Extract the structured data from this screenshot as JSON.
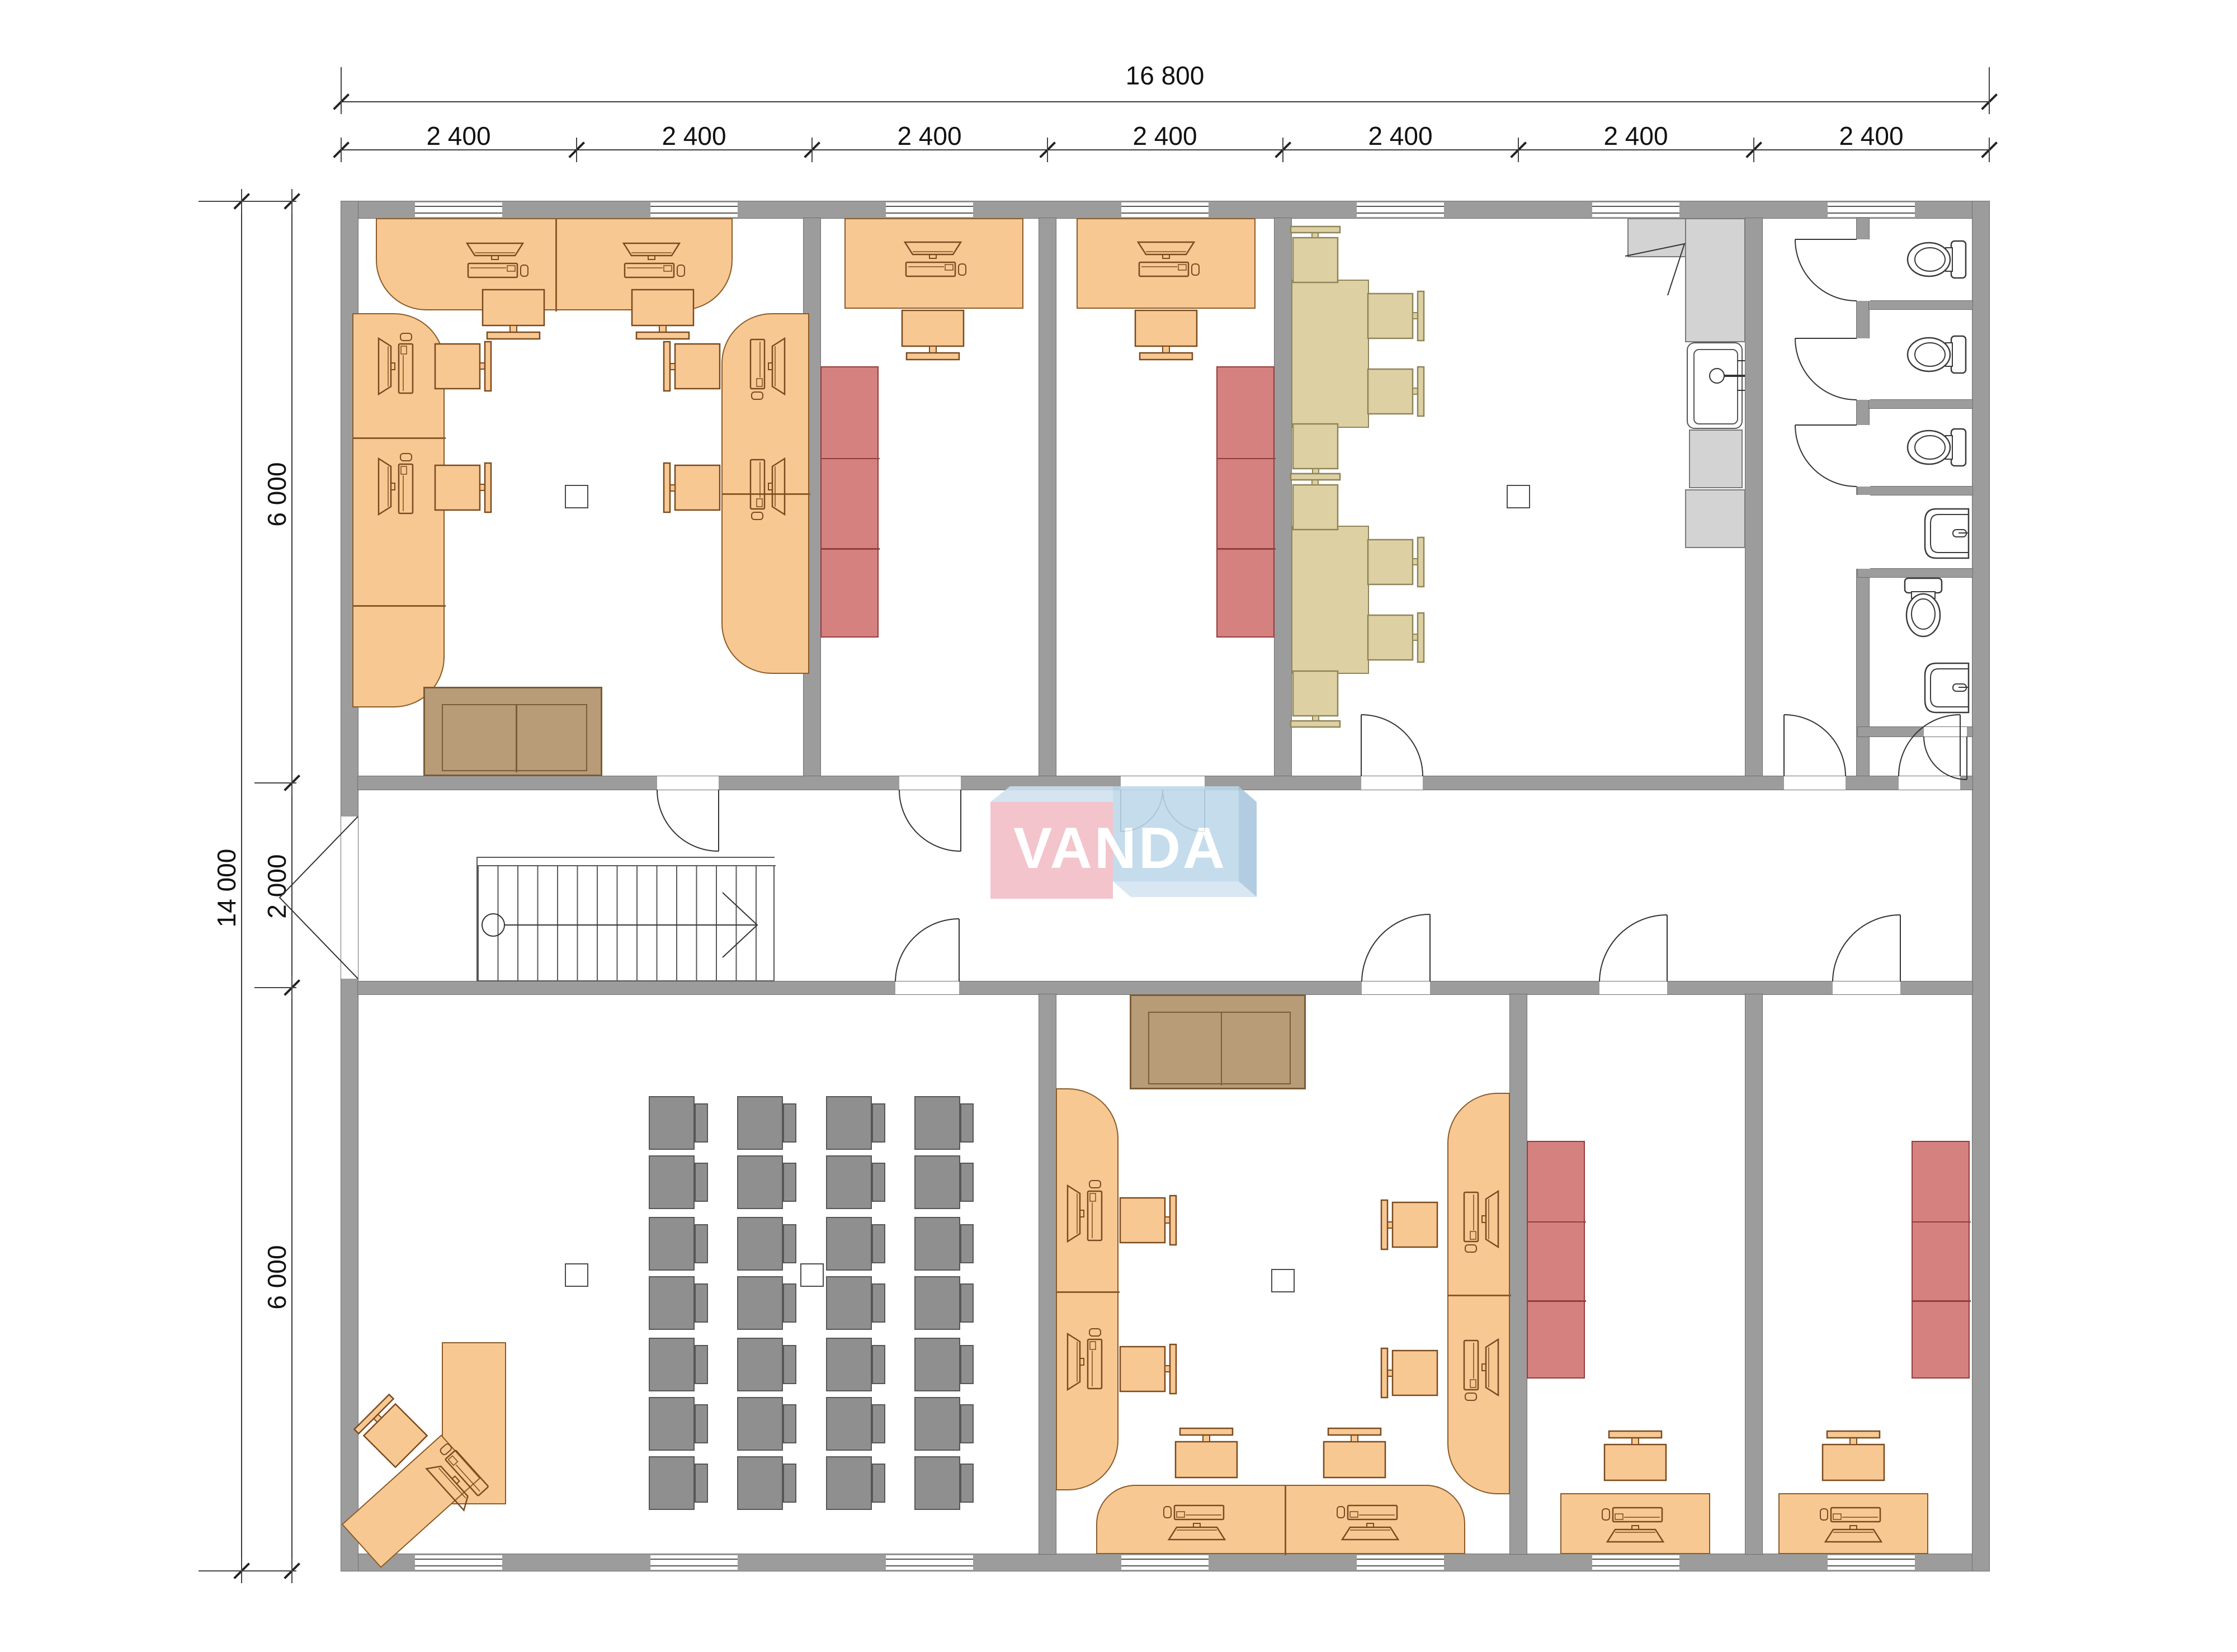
{
  "drawing": {
    "kind": "office floor plan",
    "watermark": {
      "text": "VANDA",
      "pink": "#f2bcc6",
      "blue": "#bdd8ea"
    }
  },
  "dimensions": {
    "top": {
      "total": "16 800",
      "segments": [
        "2 400",
        "2 400",
        "2 400",
        "2 400",
        "2 400",
        "2 400",
        "2 400"
      ]
    },
    "left": {
      "total": "14 000",
      "segments": [
        "6 000",
        "2 000",
        "6 000"
      ]
    }
  },
  "colors": {
    "wall": "#9c9c9c",
    "desk": "#f8c893",
    "cabinet": "#d4817f",
    "table": "#ddd1a3",
    "sofa": "#b89b77",
    "classroom_seat": "#8f8f8f",
    "kitchen": "#d3d3d3",
    "dimension_text": "#111111"
  }
}
